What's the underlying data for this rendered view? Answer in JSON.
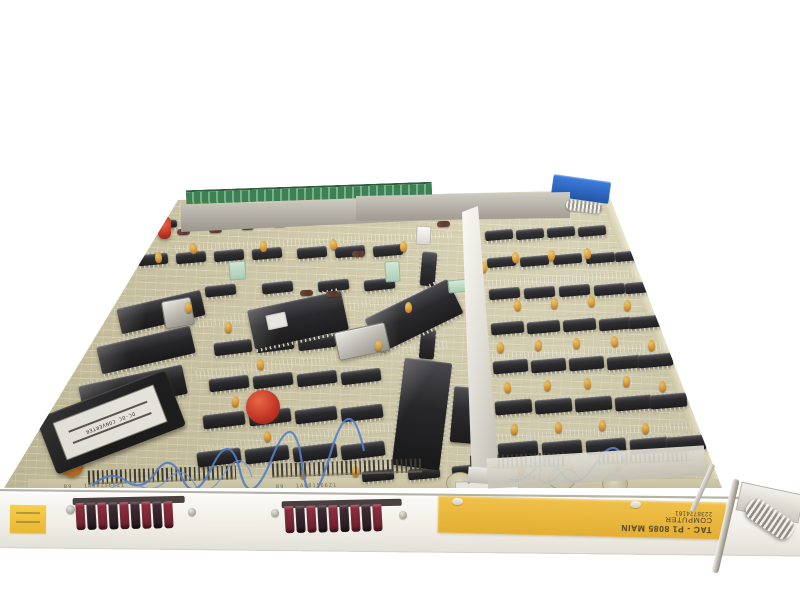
{
  "photo": {
    "description": "Vintage 8085 single-board computer circuit board photographed at an angle on a white background"
  },
  "front_panel": {
    "label_line1": "TAC - P1 8085 MAIN",
    "label_line2": "COMPUTER",
    "label_line3": "2238724161"
  },
  "modules": {
    "dcdc_label": "DC-DC CONVERTER"
  },
  "markings": {
    "silk_c51": "C51",
    "silk_c36": "C36 +",
    "silk_pe80": "PE-80",
    "edge_b9_left": "B9",
    "edge_code_left": "1A6B1566Z1",
    "edge_b9_right": "B9",
    "edge_code_right": "1A6B1566Z1"
  },
  "colors": {
    "background": "#ffffff",
    "board_base": "#d0c9a6",
    "chip_body": "#17171b",
    "chip_legs": "#d9d6c9",
    "front_panel": "#f0eee7",
    "label_yellow": "#e9b93e",
    "label_text": "#483f2c",
    "connector_red": "#7e2434",
    "connector_dark": "#33262c",
    "green_connector": "#3f7f54",
    "blue_edge_guide": "#2f6fce",
    "aluminum": "#d6d3cb",
    "capacitor_orange": "#d4741f",
    "capacitor_red": "#c92818",
    "tantalum_yellow": "#dfa133"
  }
}
